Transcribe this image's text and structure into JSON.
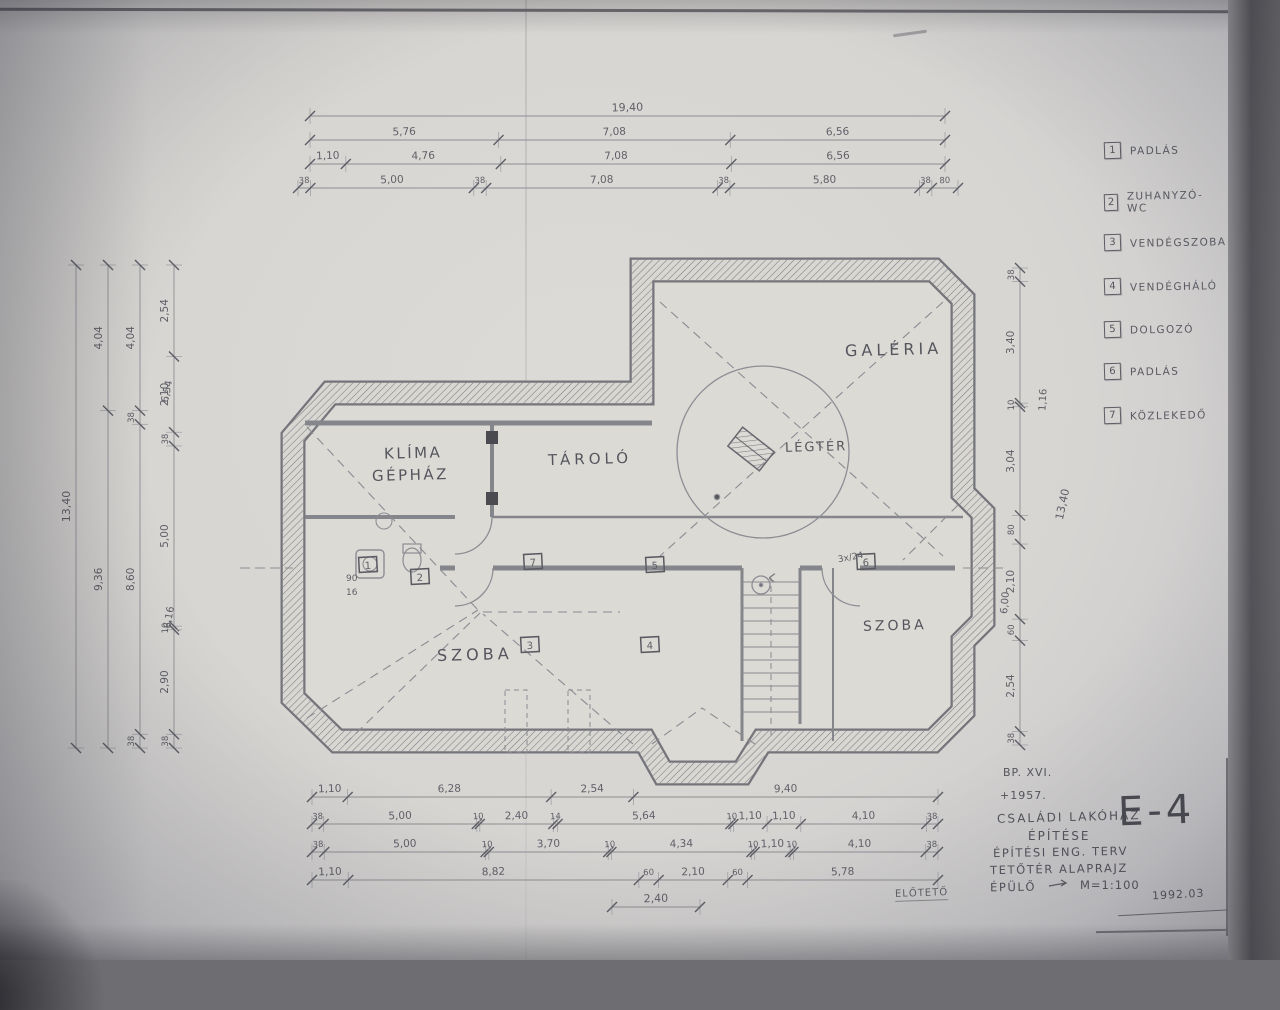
{
  "plan": {
    "rooms": {
      "klima1": "KLÍMA",
      "klima2": "GÉPHÁZ",
      "tarolo": "TÁROLÓ",
      "galeria": "GALÉRIA",
      "legter": "LÉGTÉR",
      "szoba_left": "SZOBA",
      "szoba_right": "SZOBA"
    },
    "markers": [
      "1",
      "2",
      "3",
      "4",
      "5",
      "6",
      "7"
    ],
    "notes": {
      "door_width": "90",
      "door_sub": "16",
      "stair_note": "3x/24",
      "porch_note": "ELŐTETŐ"
    }
  },
  "legend": {
    "items": [
      {
        "num": "1",
        "label": "PADLÁS"
      },
      {
        "num": "2",
        "label": "ZUHANYZÓ-WC"
      },
      {
        "num": "3",
        "label": "VENDÉGSZOBA"
      },
      {
        "num": "4",
        "label": "VENDÉGHÁLÓ"
      },
      {
        "num": "5",
        "label": "DOLGOZÓ"
      },
      {
        "num": "6",
        "label": "PADLÁS"
      },
      {
        "num": "7",
        "label": "KÖZLEKEDŐ"
      }
    ]
  },
  "title_block": {
    "line1": "BP. XVI.",
    "line2": "+1957.",
    "line3": "CSALÁDI LAKÓHÁZ",
    "line4": "ÉPÍTÉSE",
    "line5": "ÉPÍTÉSI ENG. TERV",
    "line6": "TETŐTÉR ALAPRAJZ",
    "line7": "ÉPÜLŐ",
    "scale": "M=1:100",
    "sheet": "E-4",
    "date": "1992.03"
  },
  "dimensions": {
    "top": {
      "overall": [
        "19,40"
      ],
      "row1": [
        "5,76",
        "7,08",
        "6,56"
      ],
      "row2": [
        "1,10",
        "4,76",
        "7,08",
        "6,56"
      ],
      "row3": [
        "38",
        "5,00",
        "38",
        "7,08",
        "38",
        "5,80",
        "38",
        "80"
      ]
    },
    "left": {
      "overall": [
        "13,40"
      ],
      "row1": [
        "4,04",
        "9,36"
      ],
      "row2": [
        "4,04",
        "38",
        "8,60",
        "38"
      ],
      "row3": [
        "2,54",
        "2,10",
        "38",
        "5,00",
        "10",
        "2,90",
        "38"
      ],
      "floating": [
        "6,54",
        "6,16"
      ]
    },
    "right": {
      "row1": [
        "38",
        "3,40",
        "10",
        "3,04",
        "80",
        "2,10",
        "60",
        "2,54",
        "38"
      ],
      "floating": [
        "1,16",
        "6,00",
        "13,40"
      ]
    },
    "bottom": {
      "row1": [
        "1,10",
        "6,28",
        "2,54",
        "9,40"
      ],
      "row2": [
        "38",
        "5,00",
        "10",
        "2,40",
        "14",
        "5,64",
        "10",
        "1,10",
        "1,10",
        "4,10",
        "38"
      ],
      "row3": [
        "38",
        "5,00",
        "10",
        "3,70",
        "10",
        "4,34",
        "10",
        "1,10",
        "10",
        "4,10",
        "38"
      ],
      "row4": [
        "1,10",
        "8,82",
        "60",
        "2,10",
        "60",
        "5,78"
      ],
      "row5": [
        "2,40"
      ]
    }
  }
}
